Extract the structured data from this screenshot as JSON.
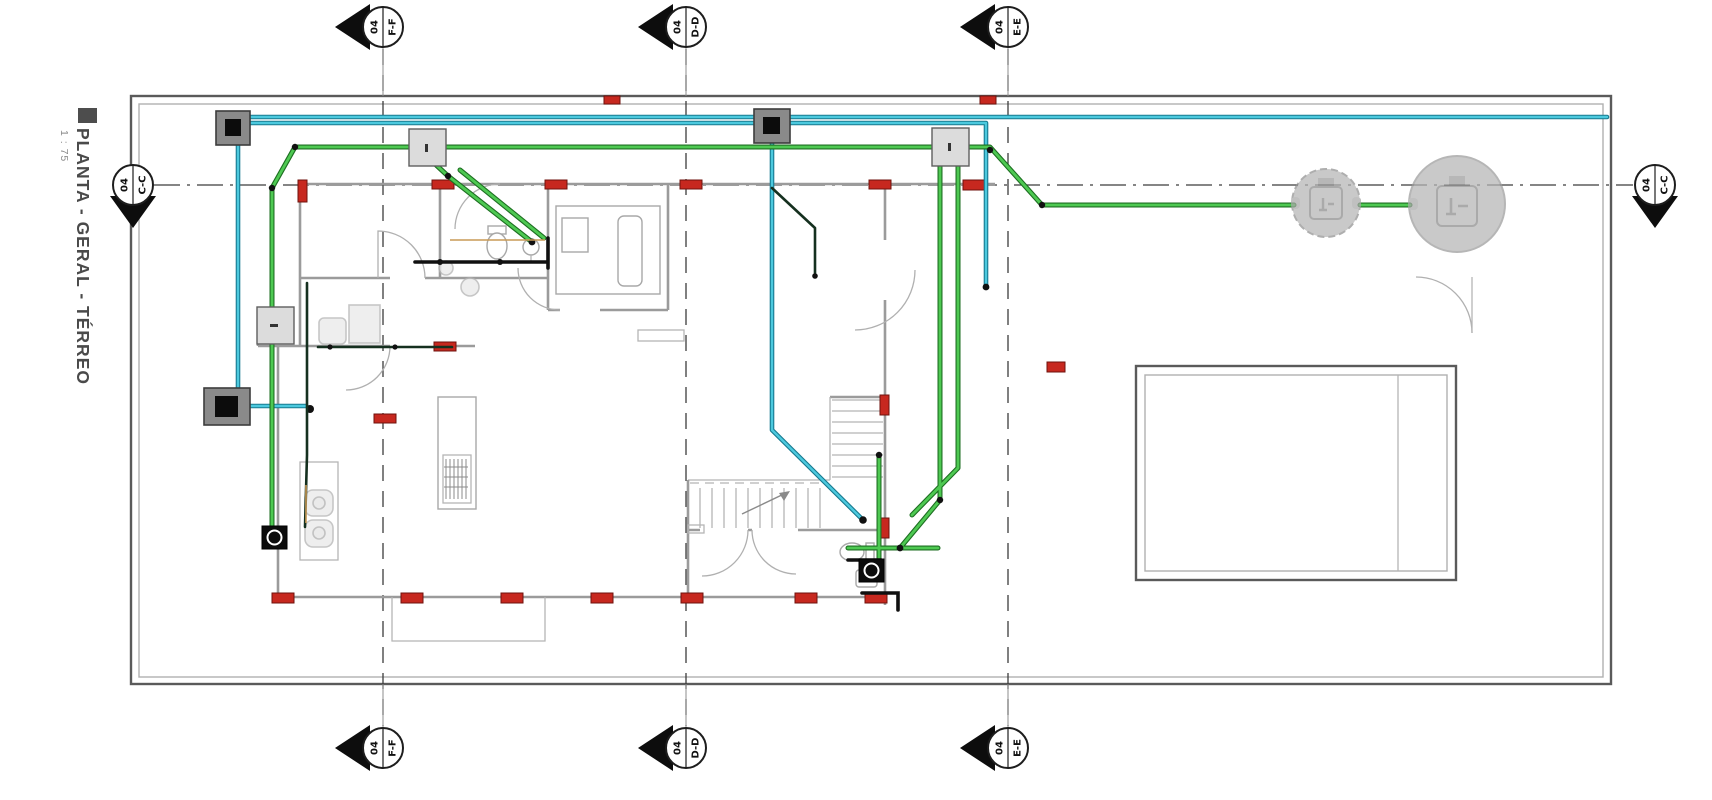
{
  "title": {
    "text": "PLANTA - GERAL - TÉRREO",
    "scale": "1 : 75"
  },
  "markers": {
    "top": [
      {
        "label": "F-F",
        "sheet": "04"
      },
      {
        "label": "D-D",
        "sheet": "04"
      },
      {
        "label": "E-E",
        "sheet": "04"
      }
    ],
    "bottom": [
      {
        "label": "F-F",
        "sheet": "04"
      },
      {
        "label": "D-D",
        "sheet": "04"
      },
      {
        "label": "E-E",
        "sheet": "04"
      }
    ],
    "left": {
      "label": "C-C",
      "sheet": "04"
    },
    "right": {
      "label": "C-C",
      "sheet": "04"
    }
  },
  "colors": {
    "sewage_pipe": "#4ec952",
    "water_pipe": "#4cc9de",
    "vent_pipe": "#15301f",
    "structural_column": "#c7281f",
    "wall": "#9b9b9b",
    "section_line": "#3c3c3c",
    "ghost_equipment": "#b4b4b4"
  },
  "icons": {
    "boxes_dark": "inspection-box-icon",
    "boxes_light": "wall-cabinet-icon",
    "boxes_black": "cleanout-box-icon",
    "tank_small": "septic-tank-icon",
    "tank_large": "anaerobic-filter-icon"
  }
}
